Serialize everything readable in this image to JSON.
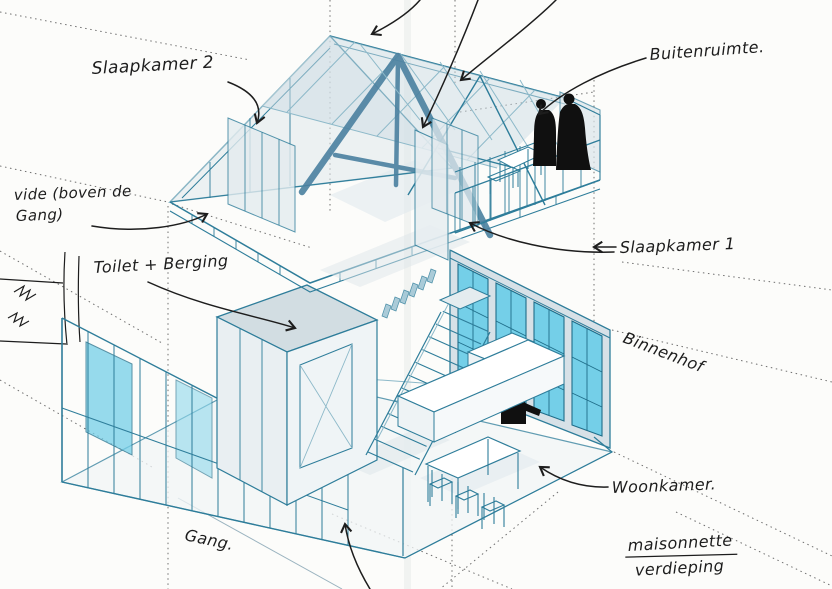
{
  "document": {
    "type": "isometric architectural concept sketch",
    "language": "Dutch",
    "caption": "maisonnette verdieping"
  },
  "labels": {
    "slaapkamer2": "Slaapkamer 2",
    "buitenruimte": "Buitenruimte.",
    "vide_line1": "vide (boven de",
    "vide_line2": "Gang)",
    "toilet_berging": "Toilet + Berging",
    "slaapkamer1": "Slaapkamer 1",
    "binnenhof": "Binnenhof",
    "woonkamer": "Woonkamer.",
    "gang": "Gang.",
    "maisonnette_line1": "maisonnette",
    "maisonnette_line2": "verdieping"
  },
  "colors": {
    "paper": "#fcfcfa",
    "ink_blue": "#2e7d9a",
    "ink_blue_light": "#8db9c9",
    "truss_dark": "#4b81a0",
    "glass_cyan": "#74cfe8",
    "panel_gray": "#dce6eb",
    "annotation_black": "#1d1d1d",
    "guide_gray": "#6f6f6f"
  },
  "drawing": {
    "upper_floor": "attic with gabled roof trusses, slaapkamer 1 + 2, vide, terrace (buitenruimte)",
    "lower_floor": "living floor with stair, kitchen counter, dining table, gang, toilet + berging, window wall to binnenhof",
    "window_wall_window_count": 4,
    "panes_per_window": 6,
    "figures_standing": 2,
    "figures_seated": 2
  }
}
